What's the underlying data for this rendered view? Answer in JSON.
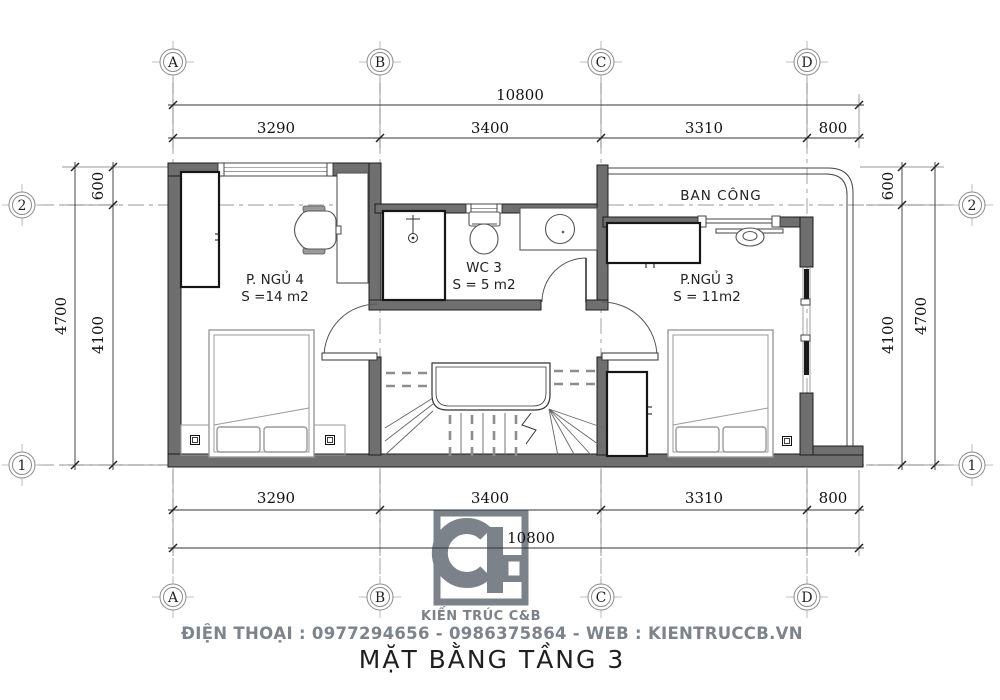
{
  "drawing": {
    "title": "MẶT BẰNG TẦNG 3",
    "company": {
      "name": "KIẾN TRÚC C&B",
      "contact_line": "ĐIỆN THOẠI : 0977294656 - 0986375864 - WEB : KIENTRUCCB.VN"
    },
    "grid": {
      "cols": [
        "A",
        "B",
        "C",
        "D"
      ],
      "rows": [
        "2",
        "1"
      ]
    },
    "dimensions": {
      "total_width": "10800",
      "top_segments": [
        "3290",
        "3400",
        "3310",
        "800"
      ],
      "bottom_segments": [
        "3290",
        "3400",
        "3310",
        "800"
      ],
      "total_depth": "4700",
      "depth_main": "4100",
      "depth_balcony": "600"
    },
    "rooms": {
      "bedroom4": {
        "name": "P. NGỦ 4",
        "area": "S =14 m2"
      },
      "wc3": {
        "name": "WC 3",
        "area": "S = 5 m2"
      },
      "bedroom3": {
        "name": "P.NGỦ 3",
        "area": "S = 11m2"
      },
      "balcony": {
        "name": "BAN CÔNG"
      }
    },
    "colors": {
      "wall": "#6f6f6f",
      "brand": "#7b8289",
      "footer_text": "#7d838a",
      "line": "#333333"
    }
  }
}
